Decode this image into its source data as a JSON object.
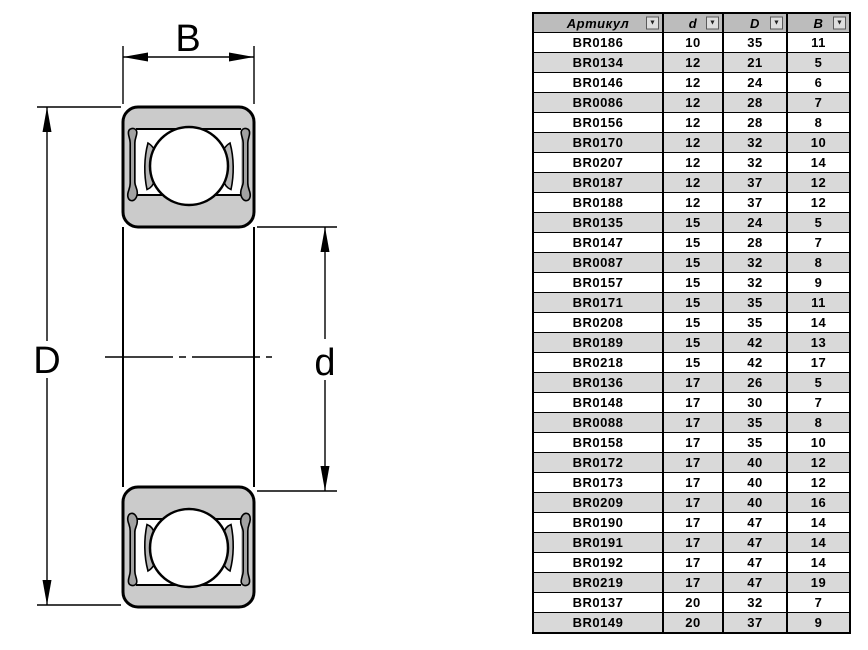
{
  "diagram": {
    "labels": {
      "width": "B",
      "outer_diameter": "D",
      "bore_diameter": "d"
    },
    "colors": {
      "ring_fill": "#cbcbcb",
      "seal_fill": "#a2a2a2",
      "cage_fill": "#b5b5b5",
      "outline": "#000000"
    }
  },
  "table": {
    "header_bg": "#bcbcbc",
    "alt_row_bg": "#d9d9d9",
    "columns": [
      {
        "label": "Артикул",
        "filter_icon": "▼"
      },
      {
        "label": "d",
        "filter_icon": "▼"
      },
      {
        "label": "D",
        "filter_icon": "▼"
      },
      {
        "label": "B",
        "filter_icon": "▼"
      }
    ],
    "rows": [
      [
        "BR0186",
        "10",
        "35",
        "11"
      ],
      [
        "BR0134",
        "12",
        "21",
        "5"
      ],
      [
        "BR0146",
        "12",
        "24",
        "6"
      ],
      [
        "BR0086",
        "12",
        "28",
        "7"
      ],
      [
        "BR0156",
        "12",
        "28",
        "8"
      ],
      [
        "BR0170",
        "12",
        "32",
        "10"
      ],
      [
        "BR0207",
        "12",
        "32",
        "14"
      ],
      [
        "BR0187",
        "12",
        "37",
        "12"
      ],
      [
        "BR0188",
        "12",
        "37",
        "12"
      ],
      [
        "BR0135",
        "15",
        "24",
        "5"
      ],
      [
        "BR0147",
        "15",
        "28",
        "7"
      ],
      [
        "BR0087",
        "15",
        "32",
        "8"
      ],
      [
        "BR0157",
        "15",
        "32",
        "9"
      ],
      [
        "BR0171",
        "15",
        "35",
        "11"
      ],
      [
        "BR0208",
        "15",
        "35",
        "14"
      ],
      [
        "BR0189",
        "15",
        "42",
        "13"
      ],
      [
        "BR0218",
        "15",
        "42",
        "17"
      ],
      [
        "BR0136",
        "17",
        "26",
        "5"
      ],
      [
        "BR0148",
        "17",
        "30",
        "7"
      ],
      [
        "BR0088",
        "17",
        "35",
        "8"
      ],
      [
        "BR0158",
        "17",
        "35",
        "10"
      ],
      [
        "BR0172",
        "17",
        "40",
        "12"
      ],
      [
        "BR0173",
        "17",
        "40",
        "12"
      ],
      [
        "BR0209",
        "17",
        "40",
        "16"
      ],
      [
        "BR0190",
        "17",
        "47",
        "14"
      ],
      [
        "BR0191",
        "17",
        "47",
        "14"
      ],
      [
        "BR0192",
        "17",
        "47",
        "14"
      ],
      [
        "BR0219",
        "17",
        "47",
        "19"
      ],
      [
        "BR0137",
        "20",
        "32",
        "7"
      ],
      [
        "BR0149",
        "20",
        "37",
        "9"
      ]
    ]
  }
}
